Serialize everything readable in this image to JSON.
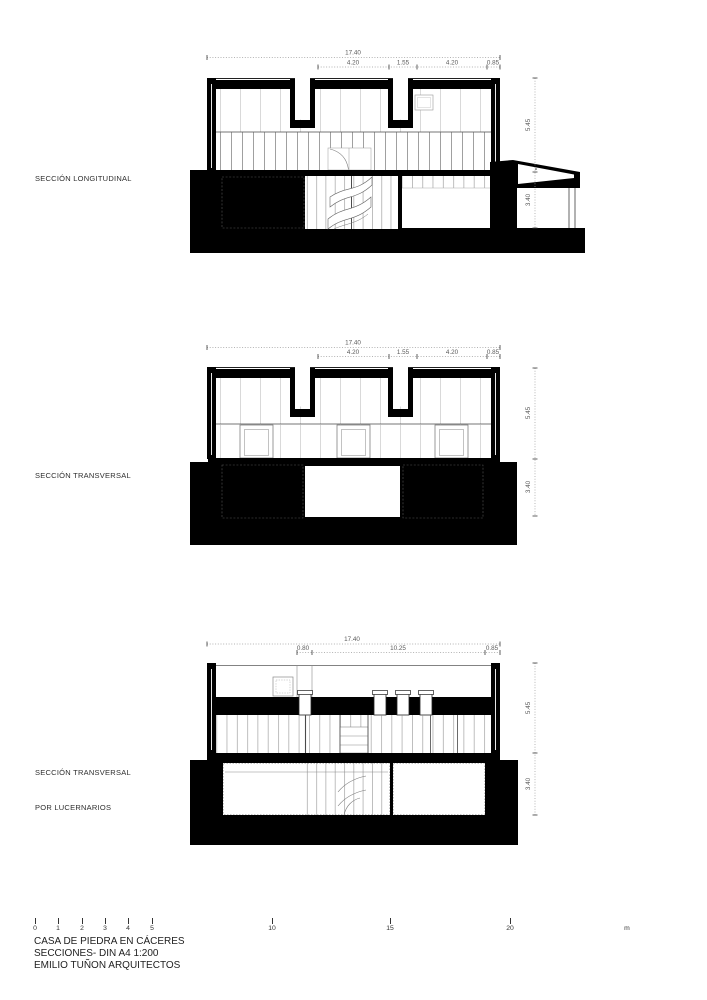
{
  "colors": {
    "ink": "#000000",
    "fine_line": "#888888",
    "dim_text": "#5a5a5a",
    "background": "#ffffff"
  },
  "sections": [
    {
      "label": "SECCIÓN LONGITUDINAL",
      "label2": "",
      "dims": {
        "total": "17.40",
        "row2": [
          "4.20",
          "1.55",
          "4.20",
          "0.85"
        ],
        "height_upper": "5.45",
        "height_lower": "3.40"
      }
    },
    {
      "label": "SECCIÓN TRANSVERSAL",
      "label2": "",
      "dims": {
        "total": "17.40",
        "row2": [
          "4.20",
          "1.55",
          "4.20",
          "0.85"
        ],
        "height_upper": "5.45",
        "height_lower": "3.40"
      }
    },
    {
      "label": "SECCIÓN TRANSVERSAL",
      "label2": "POR LUCERNARIOS",
      "dims": {
        "total": "17.40",
        "row2": [
          "0.80",
          "10.25",
          "0.85"
        ],
        "height_upper": "5.45",
        "height_lower": "3.40"
      }
    }
  ],
  "scalebar": {
    "ticks": [
      "0",
      "1",
      "2",
      "3",
      "4",
      "5",
      "10",
      "15",
      "20"
    ],
    "unit": "m"
  },
  "titleblock": {
    "line1": "CASA DE PIEDRA EN CÁCERES",
    "line2": "SECCIONES- DIN A4 1:200",
    "line3": "EMILIO TUÑON ARQUITECTOS"
  }
}
